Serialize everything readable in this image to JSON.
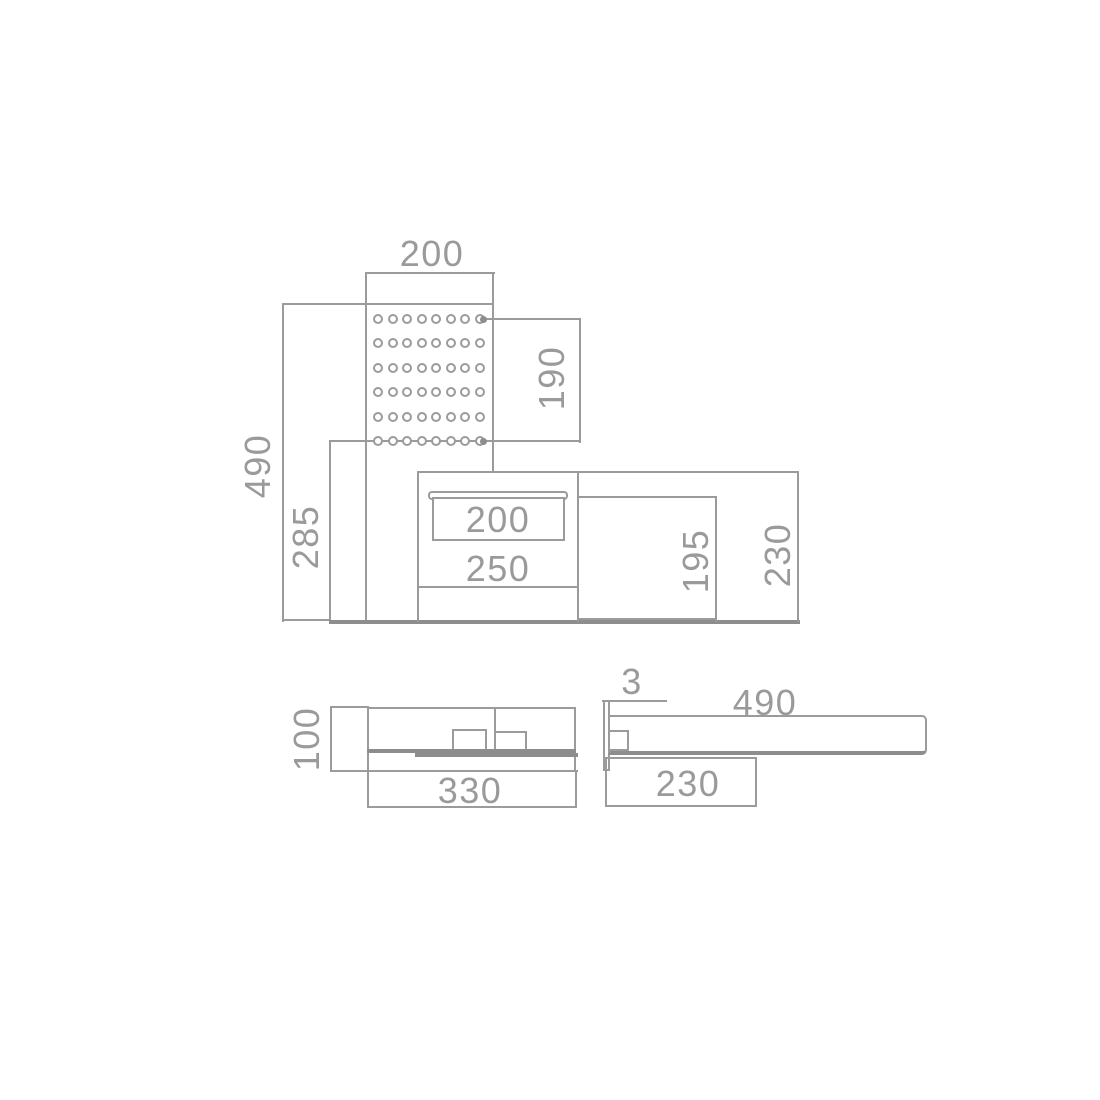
{
  "colors": {
    "background": "#ffffff",
    "line": "#9b9b9b",
    "line_thick": "#8d8d8d",
    "text": "#9a9a9a"
  },
  "front_view": {
    "labels": {
      "panel_width": "200",
      "total_height": "490",
      "lower_height": "285",
      "perforation_height": "190",
      "drawer_width": "200",
      "compartment_width": "250",
      "inner_depth": "195",
      "depth": "230"
    },
    "perforation": {
      "rows": 6,
      "cols": 8
    }
  },
  "side_view_left": {
    "labels": {
      "height": "100",
      "depth": "330"
    }
  },
  "side_view_right": {
    "labels": {
      "panel_thickness": "3",
      "length": "490",
      "depth": "230"
    }
  }
}
